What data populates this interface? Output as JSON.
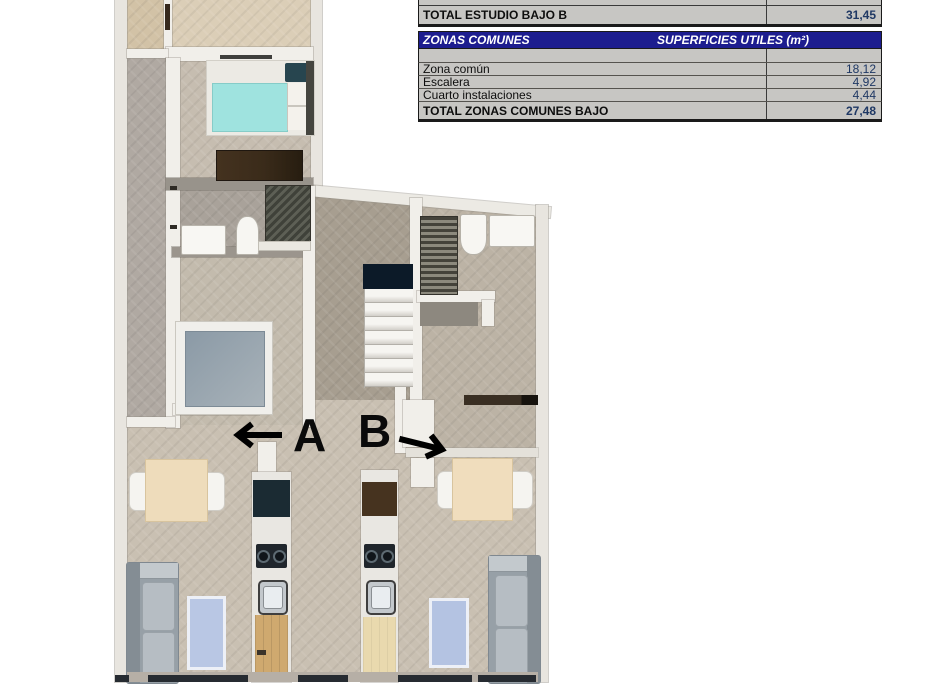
{
  "tables": {
    "estudio_bajo_b": {
      "total_row": {
        "label": "TOTAL ESTUDIO BAJO B",
        "value": "31,45"
      }
    },
    "zonas_comunes": {
      "header": {
        "title": "ZONAS COMUNES",
        "units_label": "SUPERFICIES UTILES  (m²)"
      },
      "rows": [
        {
          "label": "Zona común",
          "value": "18,12"
        },
        {
          "label": "Escalera",
          "value": "4,92"
        },
        {
          "label": "Cuarto instalaciones",
          "value": "4,44"
        }
      ],
      "total_row": {
        "label": "TOTAL ZONAS COMUNES BAJO",
        "value": "27,48"
      }
    },
    "style": {
      "header_bg": "#1d1d8f",
      "header_text": "#ffffff",
      "row_bg": "#c7c6c3",
      "value_color": "#1f3864",
      "border_color": "#1a1a1a"
    }
  },
  "floor_plan": {
    "unit_labels": [
      {
        "id": "A",
        "label": "A",
        "arrow_direction": "left"
      },
      {
        "id": "B",
        "label": "B",
        "arrow_direction": "right"
      }
    ],
    "palette": {
      "floor_beige": "#c9c0b2",
      "floor_gray": "#b0a9a2",
      "terrace": "#dbceb7",
      "wall": "#f1efea",
      "bed_mattress": "#9fe3df",
      "rug_blue": "#b9c7e4",
      "stairs_landing": "#0c1a28",
      "wood_door": "#cfa96f"
    }
  }
}
